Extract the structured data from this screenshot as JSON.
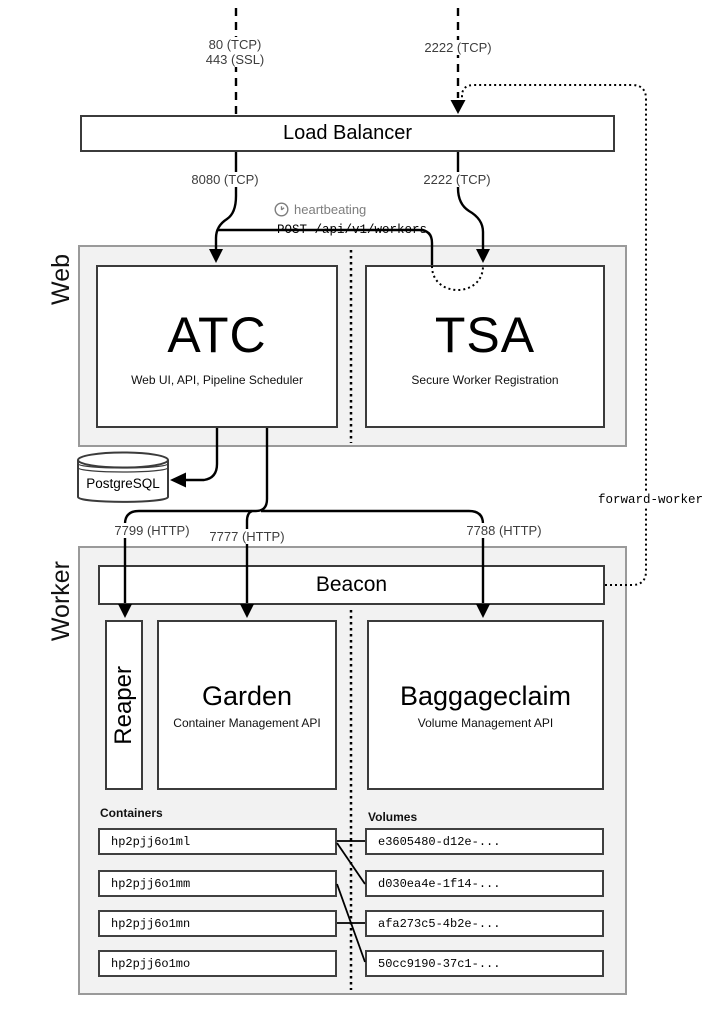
{
  "top_edges": {
    "http_port_line1": "80 (TCP)",
    "http_port_line2": "443 (SSL)",
    "ssh_port": "2222 (TCP)"
  },
  "load_balancer": {
    "label": "Load Balancer"
  },
  "lb_edges": {
    "atc_port": "8080 (TCP)",
    "tsa_port": "2222 (TCP)"
  },
  "annotations": {
    "heartbeating": "heartbeating",
    "post_workers": "POST /api/v1/workers",
    "forward_worker": "forward-worker"
  },
  "web_section": {
    "label": "Web",
    "atc": {
      "title": "ATC",
      "subtitle": "Web UI, API, Pipeline Scheduler"
    },
    "tsa": {
      "title": "TSA",
      "subtitle": "Secure Worker Registration"
    }
  },
  "database": {
    "label": "PostgreSQL"
  },
  "worker_ports": {
    "reaper": "7799 (HTTP)",
    "garden": "7777 (HTTP)",
    "baggageclaim": "7788 (HTTP)"
  },
  "worker_section": {
    "label": "Worker",
    "beacon": {
      "label": "Beacon"
    },
    "reaper": {
      "label": "Reaper"
    },
    "garden": {
      "title": "Garden",
      "subtitle": "Container Management API"
    },
    "baggageclaim": {
      "title": "Baggageclaim",
      "subtitle": "Volume Management API"
    },
    "containers": {
      "label": "Containers",
      "items": [
        "hp2pjj6o1ml",
        "hp2pjj6o1mm",
        "hp2pjj6o1mn",
        "hp2pjj6o1mo"
      ]
    },
    "volumes": {
      "label": "Volumes",
      "items": [
        "e3605480-d12e-...",
        "d030ea4e-1f14-...",
        "afa273c5-4b2e-...",
        "50cc9190-37c1-..."
      ]
    },
    "container_volume_links": [
      {
        "container": "hp2pjj6o1ml",
        "volume": "e3605480-d12e-..."
      },
      {
        "container": "hp2pjj6o1ml",
        "volume": "d030ea4e-1f14-..."
      },
      {
        "container": "hp2pjj6o1mm",
        "volume": "50cc9190-37c1-..."
      },
      {
        "container": "hp2pjj6o1mn",
        "volume": "afa273c5-4b2e-..."
      }
    ]
  },
  "colors": {
    "section_fill": "#f2f2f2",
    "section_border": "#9a9a9a",
    "box_border": "#3b3b3b",
    "line": "#000000",
    "port_text": "#3d3d3d",
    "heartbeat_text": "#7d7d7d"
  }
}
